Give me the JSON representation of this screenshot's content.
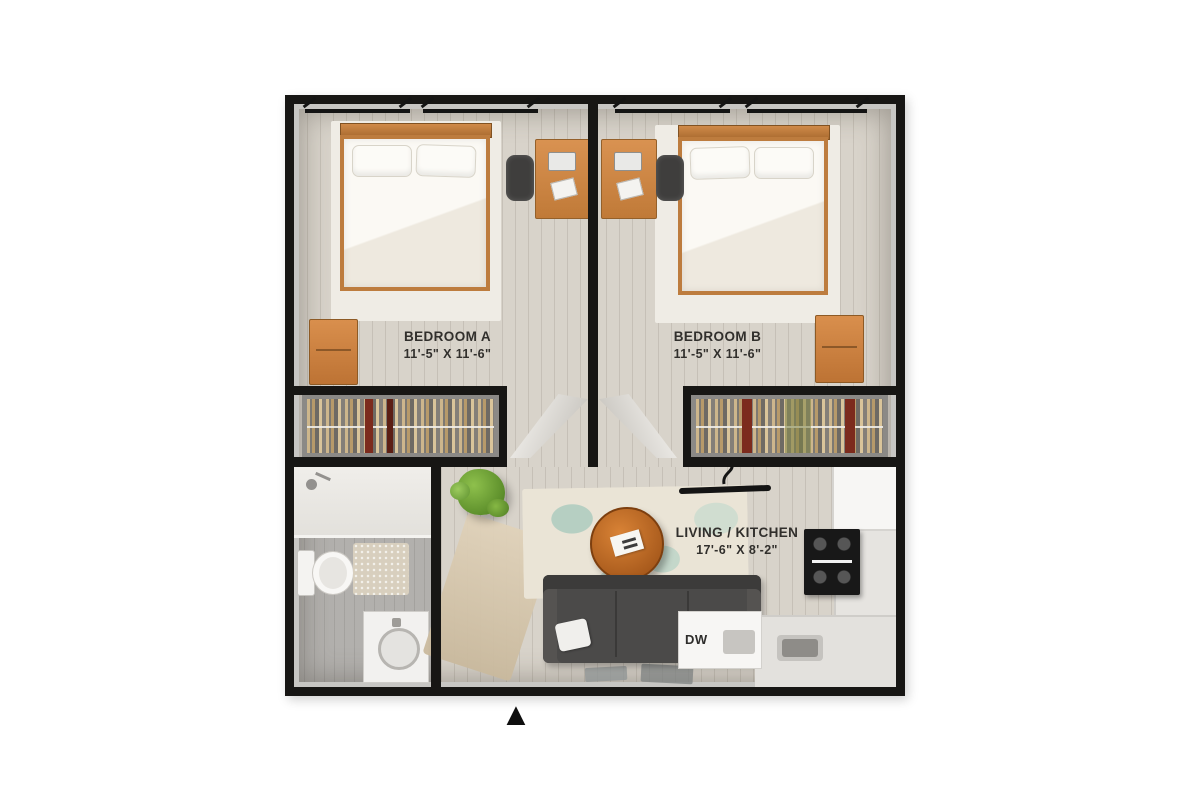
{
  "rooms": {
    "bedroom_a": {
      "label": "BEDROOM A",
      "dims": "11'-5\" X 11'-6\""
    },
    "bedroom_b": {
      "label": "BEDROOM B",
      "dims": "11'-5\" X 11'-6\""
    },
    "living_kitchen": {
      "label": "LIVING / KITCHEN",
      "dims": "17'-6\" X 8'-2\""
    }
  },
  "labels": {
    "dishwasher": "DW"
  },
  "markers": {
    "entry": "▲"
  },
  "colors": {
    "wall": "#171614",
    "wood_accent": "#cb8344",
    "bedding": "#f6f3ec",
    "floor": "#d8d3ca",
    "bathroom_floor": "#b2b0ad",
    "sofa": "#4b4a49",
    "coffee_table": "#c06b28",
    "plant": "#6fae3e",
    "rug": "#eae4d7",
    "text": "#312f2c",
    "background": "#ffffff"
  },
  "furniture": {
    "bedroom_a": [
      "bed",
      "desk",
      "desk-chair",
      "nightstand",
      "closet"
    ],
    "bedroom_b": [
      "bed",
      "desk",
      "desk-chair",
      "nightstand",
      "closet"
    ],
    "bathroom": [
      "shower",
      "toilet",
      "bath-mat",
      "vanity-sink"
    ],
    "living_kitchen": [
      "plant",
      "side-table",
      "rug",
      "round-coffee-table",
      "sofa",
      "ceiling-light",
      "refrigerator",
      "stove",
      "kitchen-counter",
      "dishwasher",
      "sink"
    ]
  }
}
